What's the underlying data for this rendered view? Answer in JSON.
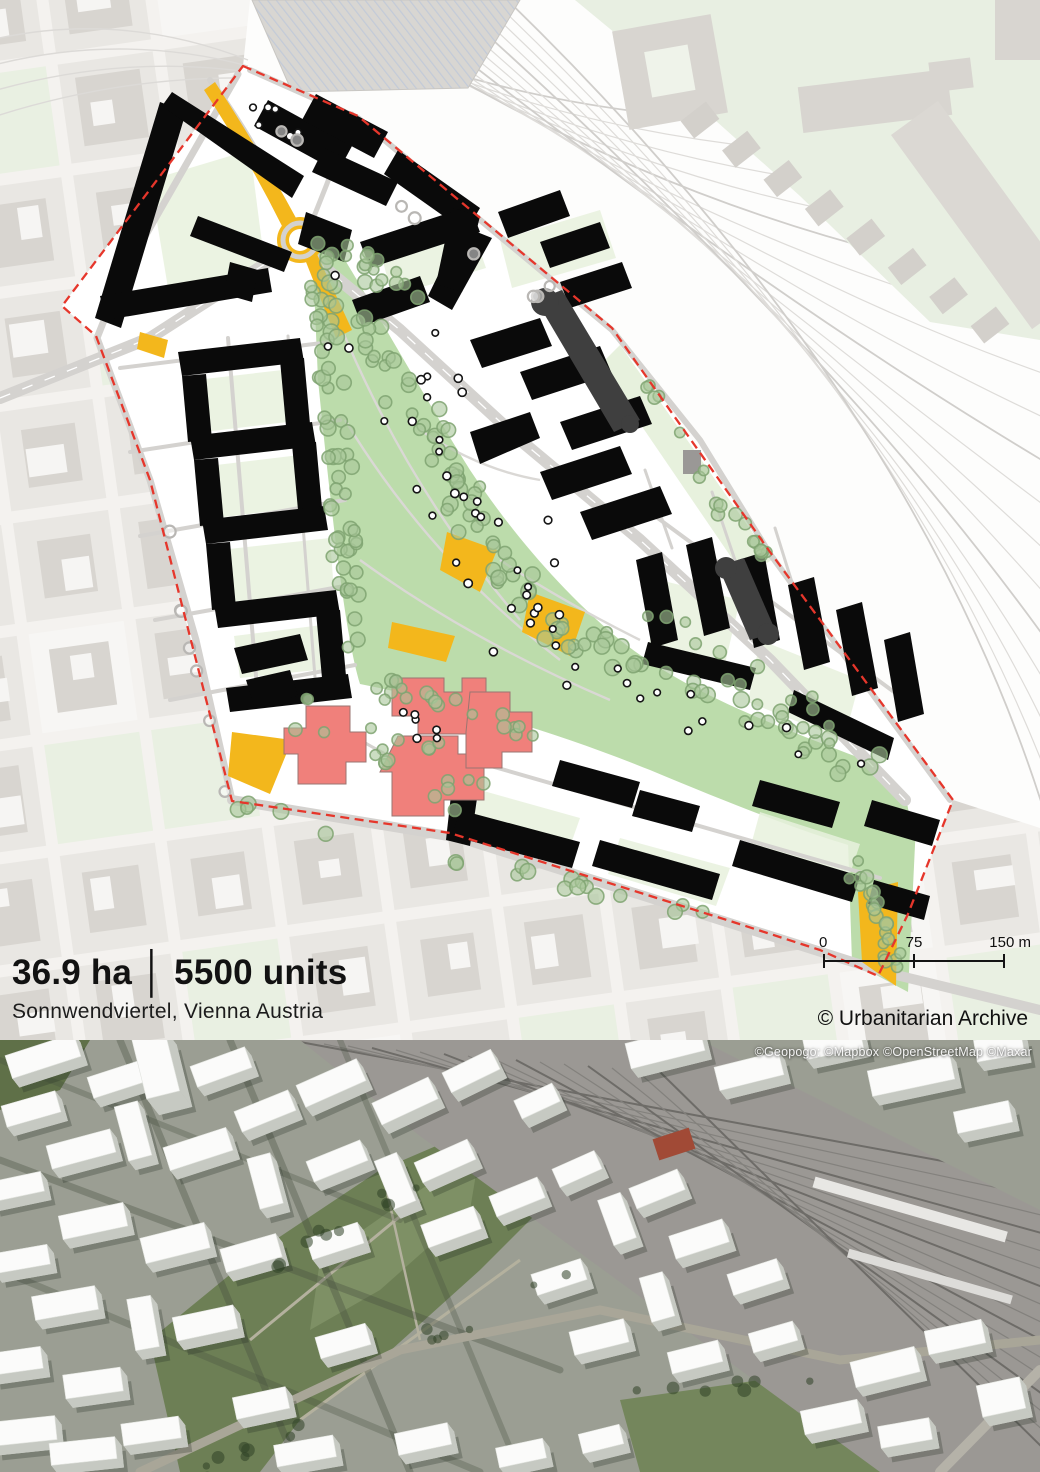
{
  "header": {
    "area": "36.9 ha",
    "separator": "│",
    "units": "5500 units",
    "location": "Sonnwendviertel, Vienna Austria"
  },
  "credit": "© Urbanitarian Archive",
  "scalebar": {
    "start": "0",
    "mid": "75",
    "end": "150 m"
  },
  "aerial": {
    "attribution": "©Geopogo: ©Mapbox ©OpenStreetMap ©Maxar"
  },
  "map": {
    "colors": {
      "site_boundary": "#e6362b",
      "new_buildings": "#0a0a0a",
      "special_buildings": "#3f3f3f",
      "campus_buildings": "#f0807b",
      "park_green": "#bcdcab",
      "courtyard_green": "#e7f1dd",
      "plaza_accent": "#f3b71c",
      "context_building": "#d8d5d0",
      "context_ground": "#f4f2ef",
      "road": "#d4d2cf",
      "tree_fill": "#a9c79a",
      "tree_stroke": "#7fa371"
    }
  }
}
